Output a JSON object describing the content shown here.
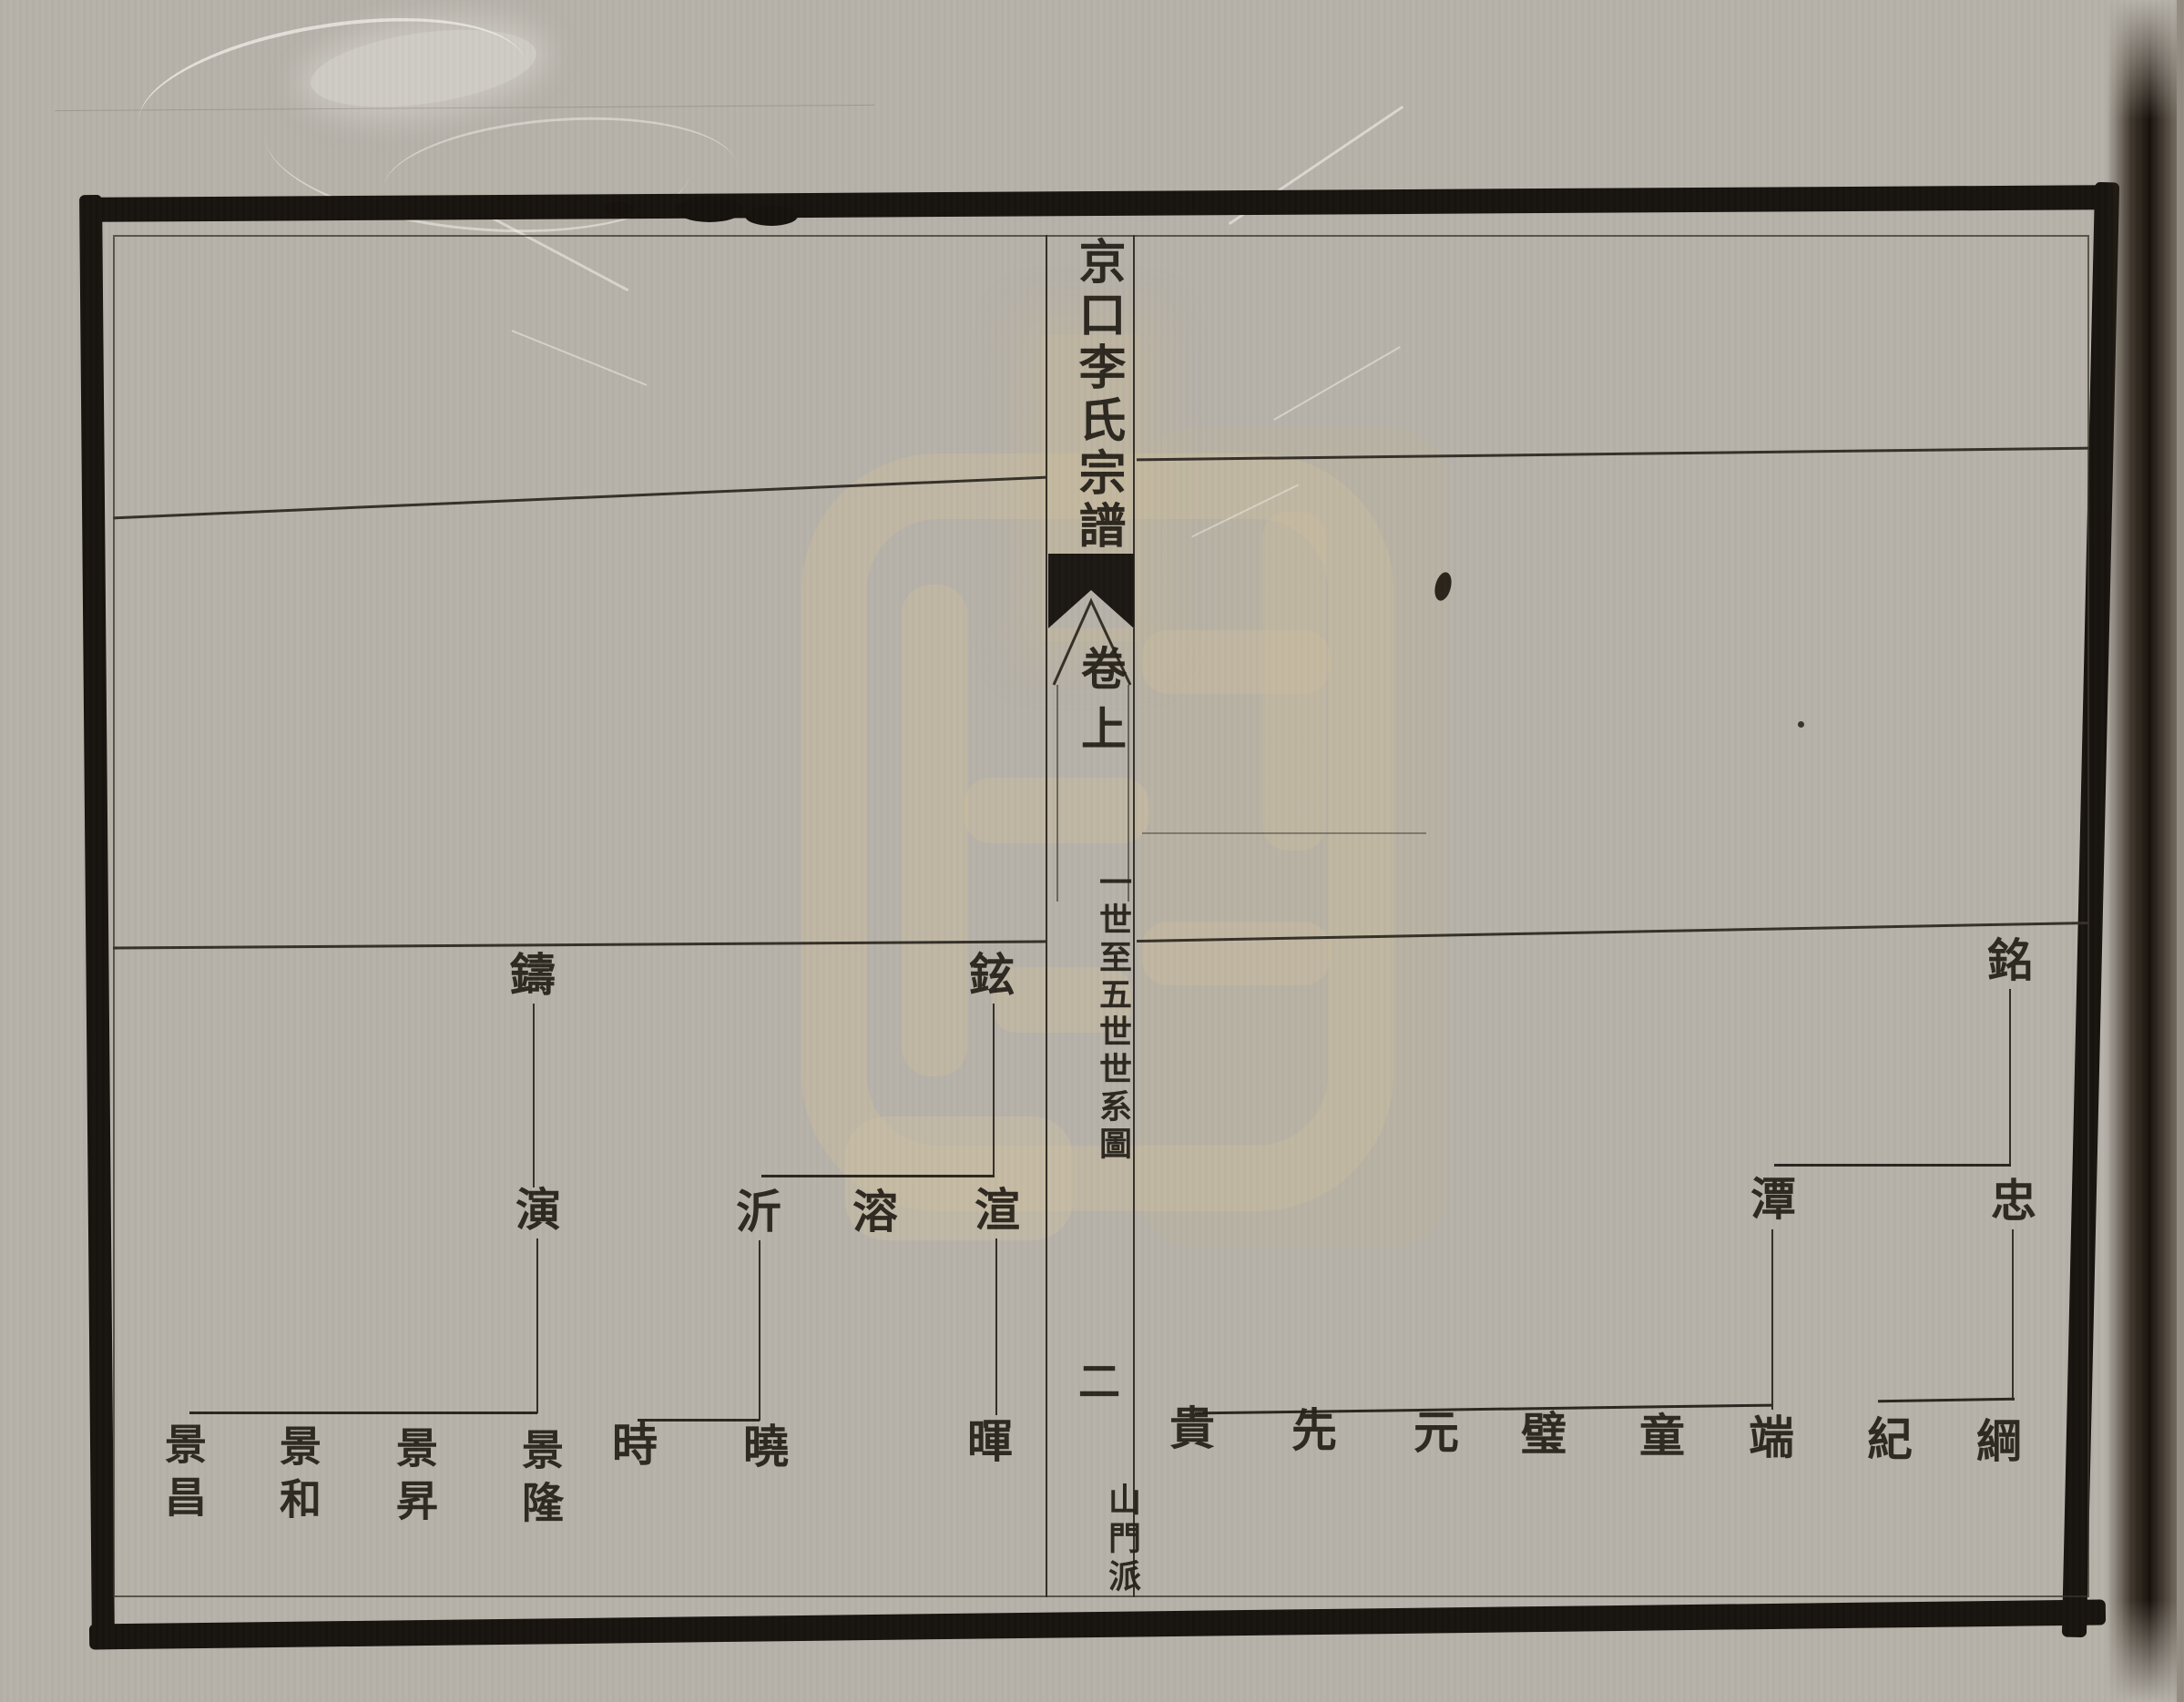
{
  "spine": {
    "title": "京口李氏宗譜",
    "volume": "卷上",
    "section": "一世至五世世系圖",
    "page_number": "二",
    "branch": "山門派"
  },
  "tree": {
    "left_page": {
      "generation1": [
        {
          "name": "鑄"
        },
        {
          "name": "鉉"
        }
      ],
      "generation2": [
        {
          "name": "演"
        },
        {
          "name": "沂"
        },
        {
          "name": "溶"
        },
        {
          "name": "渲"
        }
      ],
      "generation3": [
        {
          "name": "景昌"
        },
        {
          "name": "景和"
        },
        {
          "name": "景昇"
        },
        {
          "name": "景隆"
        },
        {
          "name": "時"
        },
        {
          "name": "曉"
        },
        {
          "name": "暉"
        }
      ]
    },
    "right_page": {
      "generation1": [
        {
          "name": "銘"
        }
      ],
      "generation2": [
        {
          "name": "潭"
        },
        {
          "name": "忠"
        }
      ],
      "generation3": [
        {
          "name": "貴"
        },
        {
          "name": "先"
        },
        {
          "name": "元"
        },
        {
          "name": "璧"
        },
        {
          "name": "童"
        },
        {
          "name": "端"
        },
        {
          "name": "紀"
        },
        {
          "name": "綱"
        }
      ]
    }
  },
  "colors": {
    "ink": "#29241d",
    "border": "#17130e",
    "paper": "#b6b1a9",
    "watermark_tan": "#cebe9e"
  }
}
